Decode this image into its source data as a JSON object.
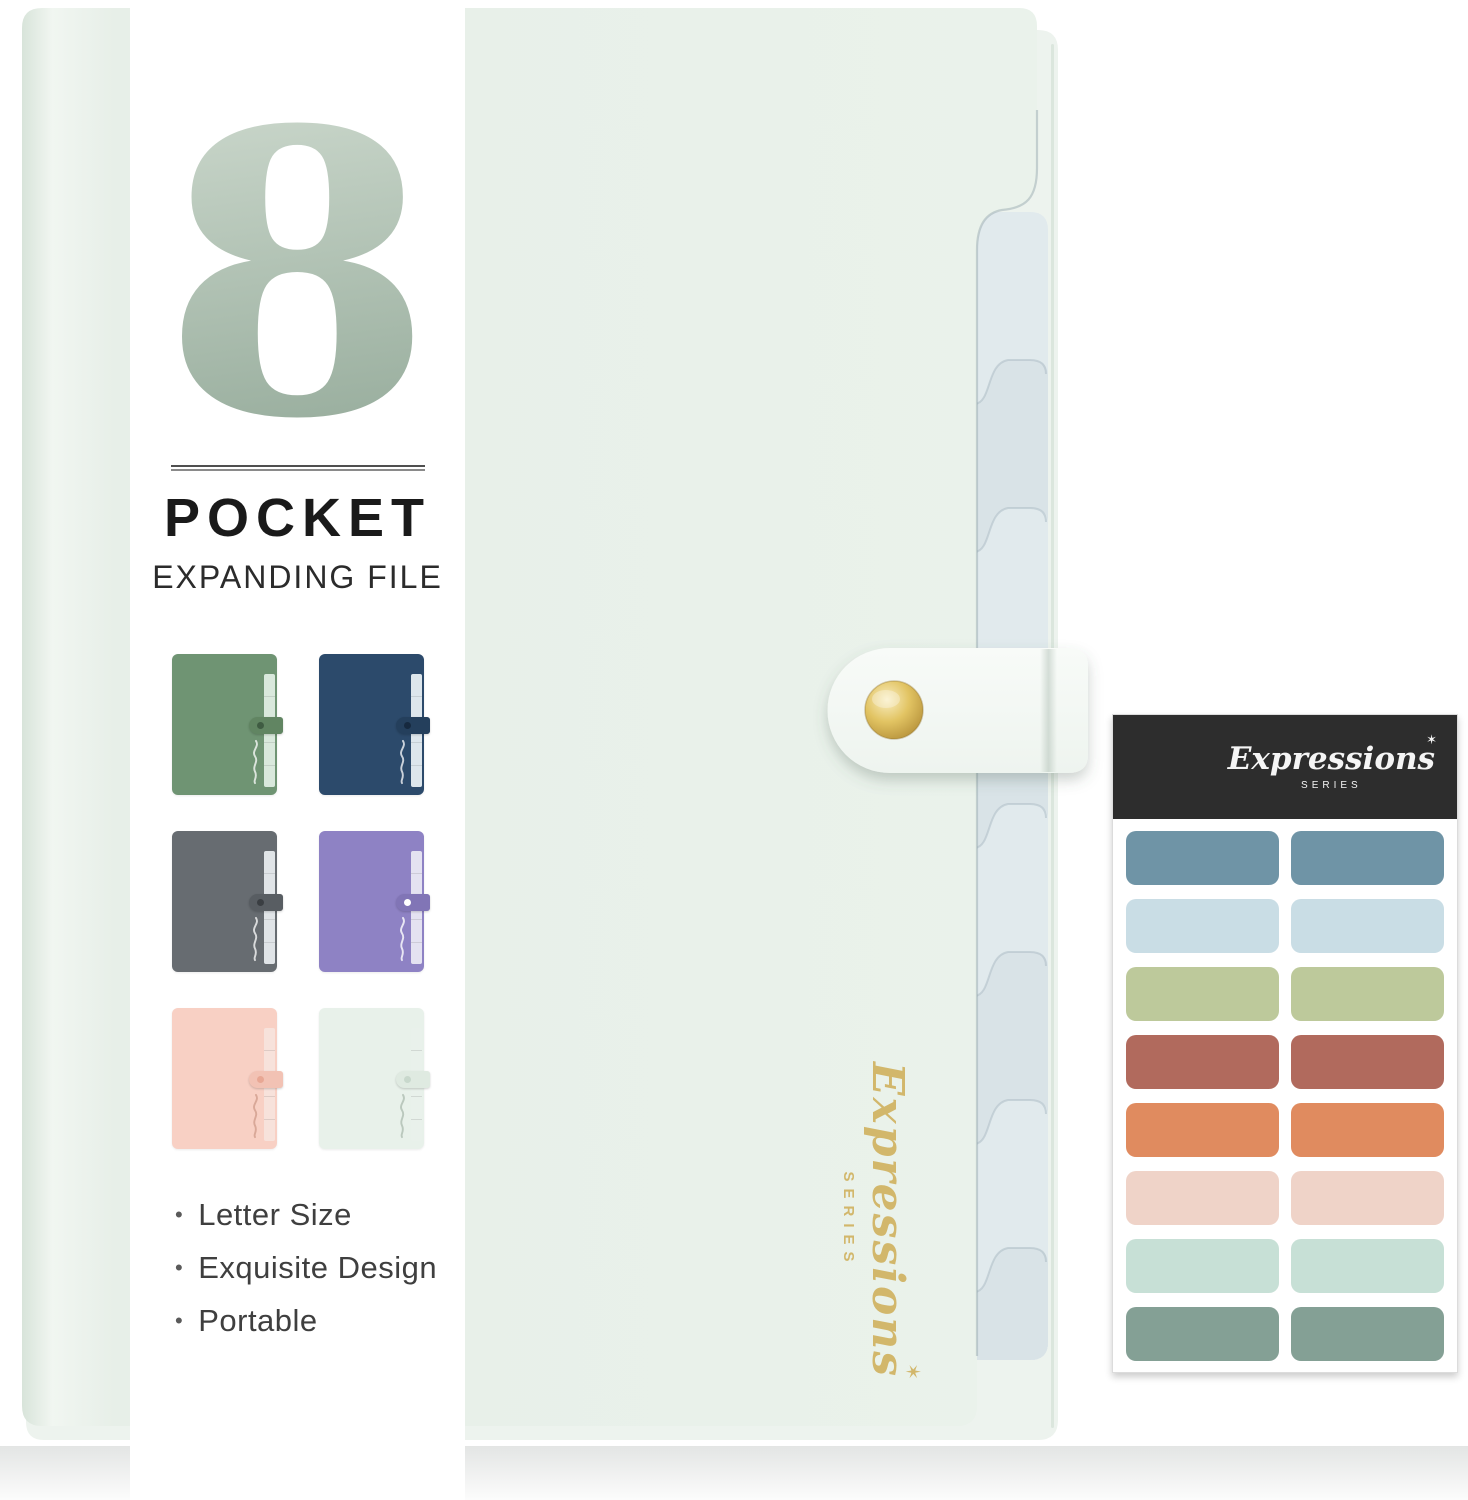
{
  "left_panel": {
    "big_number": "8",
    "title": "POCKET",
    "subtitle": "EXPANDING FILE",
    "bullet": "•",
    "features": [
      "Letter Size",
      "Exquisite Design",
      "Portable"
    ]
  },
  "brand": {
    "script": "Expressions",
    "star": "✶",
    "series": "SERIES"
  },
  "swatches": [
    {
      "name": "green",
      "body": "#6f9473",
      "tab": "#d9e8dc",
      "strap": "#618562",
      "dot": "#3f5c42",
      "mark": "rgba(255,255,255,0.75)"
    },
    {
      "name": "navy",
      "body": "#2c4a6b",
      "tab": "#dde6ec",
      "strap": "#243f5c",
      "dot": "#16293f",
      "mark": "rgba(255,255,255,0.75)"
    },
    {
      "name": "gray",
      "body": "#676c71",
      "tab": "#e0e4e7",
      "strap": "#585d62",
      "dot": "#3a3e42",
      "mark": "rgba(255,255,255,0.75)"
    },
    {
      "name": "purple",
      "body": "#8e82c4",
      "tab": "#e4e2f1",
      "strap": "#8175b6",
      "dot": "#ffffff",
      "mark": "rgba(255,255,255,0.80)"
    },
    {
      "name": "pink",
      "body": "#f8d0c4",
      "tab": "#f7e2db",
      "strap": "#f2c2b4",
      "dot": "#e8a794",
      "mark": "rgba(180,120,100,0.45)"
    },
    {
      "name": "mint",
      "body": "#e8f1ea",
      "tab": "#e9f1eb",
      "strap": "#dfeae1",
      "dot": "#c8d8cc",
      "mark": "rgba(130,150,135,0.45)"
    }
  ],
  "sticker_sheet": {
    "stickers": [
      {
        "color": "#6f94a6"
      },
      {
        "color": "#6f94a6"
      },
      {
        "color": "#c9dde5"
      },
      {
        "color": "#c9dde5"
      },
      {
        "color": "#bdc99b"
      },
      {
        "color": "#bdc99b"
      },
      {
        "color": "#b16a5d"
      },
      {
        "color": "#b16a5d"
      },
      {
        "color": "#e08b5f"
      },
      {
        "color": "#e08b5f"
      },
      {
        "color": "#efd3c8"
      },
      {
        "color": "#efd3c8"
      },
      {
        "color": "#c7e0d6"
      },
      {
        "color": "#c7e0d6"
      },
      {
        "color": "#84a095"
      },
      {
        "color": "#84a095"
      }
    ]
  },
  "colors": {
    "folder_cover": "#e7efe8",
    "folder_cover_right": "#eaf2eb",
    "folder_cover_edge": "#d8e4da",
    "folder_back": "#edf3ee",
    "folder_back_edge": "#dbe6dd",
    "tab_strip": "#d9e3e7",
    "tab_strip_light": "#e1eaed",
    "tab_shadow": "#aebec6",
    "strap_light": "#f8fbf8",
    "strap_dark": "#eef4ef",
    "gold_button_light": "#f9eec2",
    "gold_button_mid": "#e2c463",
    "gold_button_dark": "#ab8530",
    "gold_foil": "#d2b76b",
    "number_top": "#c8d5c9",
    "number_bottom": "#9aaf9f",
    "rule_dark": "#4f4f4f",
    "rule_light": "#8a8a8a",
    "title_color": "#1a1a1a",
    "subtitle_color": "#2b2b2b",
    "feature_color": "#3f3f3f",
    "bullet_color": "#5a5a5a",
    "sheet_bg": "#ffffff",
    "sheet_border": "#dcdcdc",
    "sheet_header": "#2d2d2d",
    "logo_white": "#f5f5f5",
    "reflection_top": "#e3e5e4",
    "reflection_bottom": "#fcfcfc"
  }
}
